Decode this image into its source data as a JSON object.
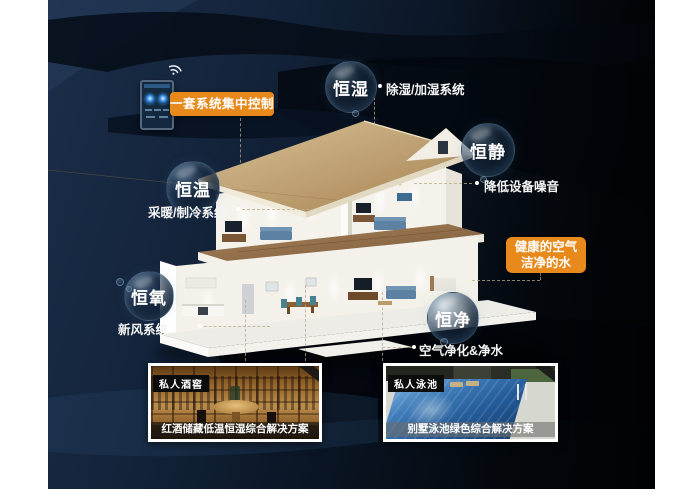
{
  "scene": {
    "control_label": "一套系统集中控制",
    "highlight_line1": "健康的空气",
    "highlight_line2": "洁净的水"
  },
  "bubbles": [
    {
      "title": "恒湿",
      "note": "除湿/加湿系统"
    },
    {
      "title": "恒静",
      "note": "降低设备噪音"
    },
    {
      "title": "恒温",
      "note": "采暖/制冷系统"
    },
    {
      "title": "恒氧",
      "note": "新风系统"
    },
    {
      "title": "恒净",
      "note": "空气净化&净水"
    }
  ],
  "cards": [
    {
      "tag": "私人酒窖",
      "caption": "红酒储藏低温恒湿综合解决方案"
    },
    {
      "tag": "私人泳池",
      "caption": "别墅泳池绿色综合解决方案"
    }
  ],
  "colors": {
    "accent_orange": "#E8891C",
    "background_navy": "#0E1B2C",
    "bubble_text": "#FFFFFF"
  }
}
